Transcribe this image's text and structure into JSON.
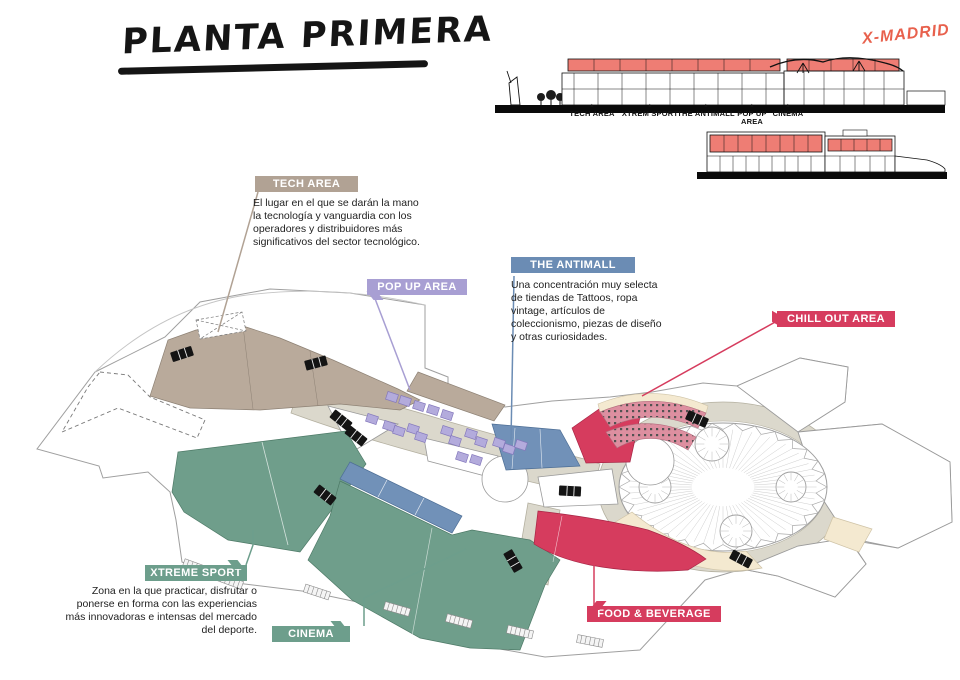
{
  "title": "PLANTA PRIMERA",
  "brand": "X-MADRID",
  "sections": {
    "marker": "▲",
    "labels": [
      "TECH AREA",
      "XTREM SPORT",
      "THE ANTIMALL",
      "POP UP AREA",
      "CINEMA"
    ]
  },
  "areas": {
    "tech": {
      "label": "TECH AREA",
      "color": "#b1a294",
      "description": "El lugar en el que se darán la mano la tecnología y vanguardia con los operadores y distribuidores más significativos del sector tecnológico."
    },
    "popup": {
      "label": "POP UP AREA",
      "color": "#a89fd3"
    },
    "antimall": {
      "label": "THE ANTIMALL",
      "color": "#6b8cb4",
      "description": "Una concentración muy selecta de tiendas de Tattoos, ropa vintage, artículos de coleccionismo, piezas de diseño y otras curiosidades."
    },
    "chillout": {
      "label": "CHILL OUT AREA",
      "color": "#d63c5e"
    },
    "xtreme": {
      "label": "XTREME SPORT",
      "color": "#6d9e8c",
      "description": "Zona en la que practicar, disfrutar o ponerse en forma con las experiencias más innovadoras e intensas del mercado del deporte."
    },
    "cinema": {
      "label": "CINEMA",
      "color": "#6d9e8c"
    },
    "food": {
      "label": "FOOD & BEVERAGE",
      "color": "#d63c5e"
    }
  },
  "plan_colors": {
    "walkway": "#dbd8cc",
    "cream": "#f4e9d0",
    "pink_seating": "#dd8fa0",
    "section_highlight": "#ee7d74",
    "brand_red": "#e8614d"
  }
}
